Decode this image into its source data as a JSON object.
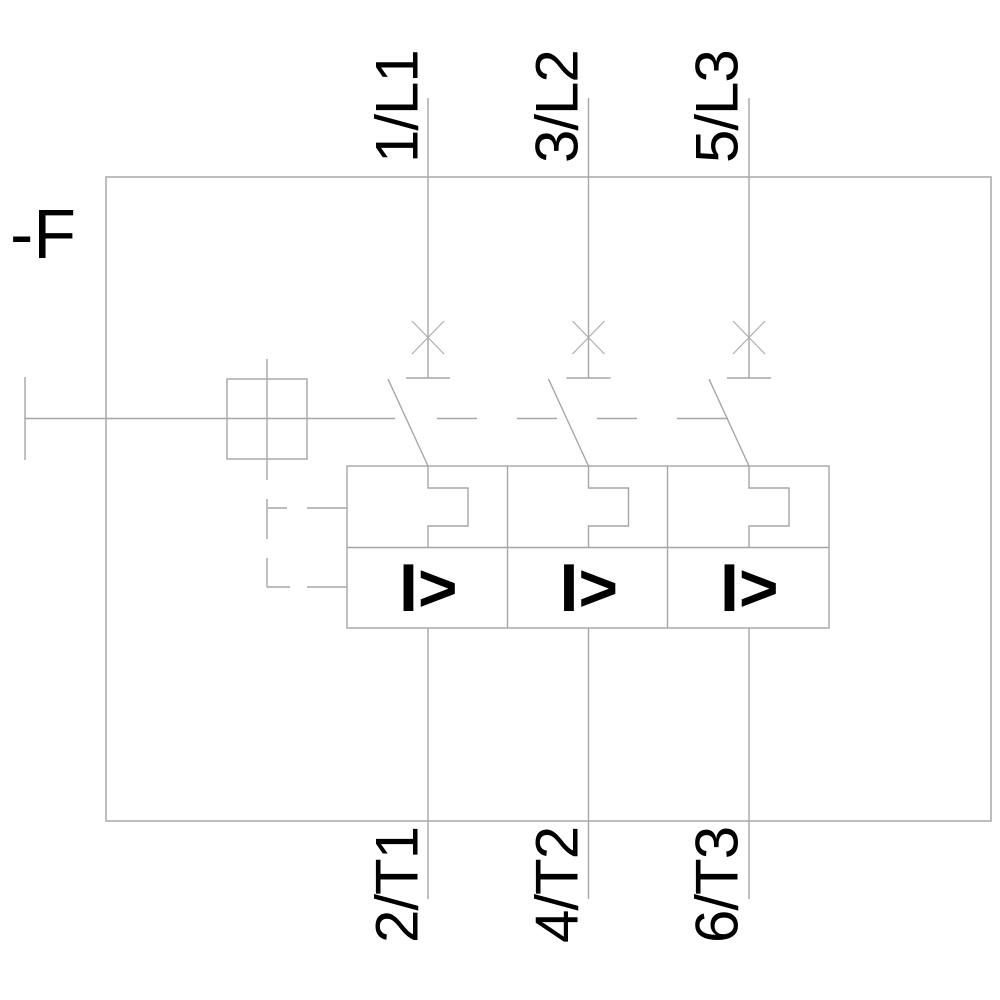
{
  "schematic": {
    "device_label": "-F",
    "poles": [
      {
        "top_terminal": "1/L1",
        "bottom_terminal": "2/T1",
        "overcurrent_symbol": "I>"
      },
      {
        "top_terminal": "3/L2",
        "bottom_terminal": "4/T2",
        "overcurrent_symbol": "I>"
      },
      {
        "top_terminal": "5/L3",
        "bottom_terminal": "6/T3",
        "overcurrent_symbol": "I>"
      }
    ],
    "colors": {
      "background": "#ffffff",
      "line": "#a6a6a6",
      "frame": "#b2b2b2",
      "text": "#000000",
      "symbol": "#000000"
    }
  }
}
